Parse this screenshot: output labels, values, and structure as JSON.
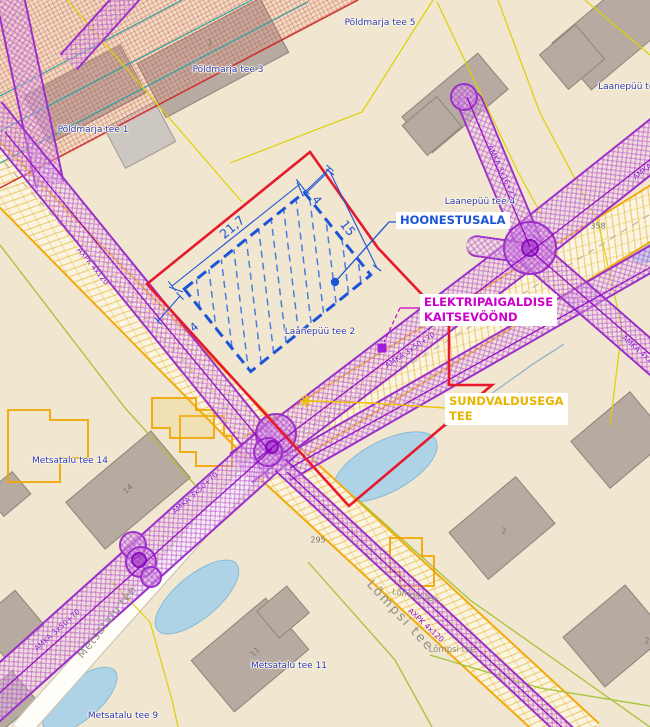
{
  "map": {
    "street_labels": [
      {
        "text": "Põldmarja tee 5",
        "x": 380,
        "y": 23
      },
      {
        "text": "Põldmarja tee 3",
        "x": 228,
        "y": 70
      },
      {
        "text": "Põldmarja tee 1",
        "x": 93,
        "y": 130
      },
      {
        "text": "Laanepüü tee",
        "x": 629,
        "y": 87
      },
      {
        "text": "Laanepüü tee 4",
        "x": 480,
        "y": 202
      },
      {
        "text": "Laanepüü tee 2",
        "x": 320,
        "y": 332
      },
      {
        "text": "Metsatalu tee 14",
        "x": 70,
        "y": 461
      },
      {
        "text": "Metsatalu tee 11",
        "x": 289,
        "y": 666
      },
      {
        "text": "Metsatalu tee 9",
        "x": 123,
        "y": 716
      }
    ],
    "parcel_labels": [
      {
        "text": "358",
        "x": 598,
        "y": 226,
        "rot": 0
      },
      {
        "text": "295",
        "x": 318,
        "y": 540,
        "rot": 0
      },
      {
        "text": "1",
        "x": 210,
        "y": 43,
        "rot": 0
      },
      {
        "text": "14",
        "x": 128,
        "y": 489,
        "rot": -45
      },
      {
        "text": "11",
        "x": 255,
        "y": 652,
        "rot": -45
      },
      {
        "text": "2",
        "x": 504,
        "y": 531,
        "rot": 0
      },
      {
        "text": "2",
        "x": 647,
        "y": 641,
        "rot": 0
      }
    ],
    "road_labels": [
      {
        "text": "Lõmpsi tee",
        "x": 400,
        "y": 616,
        "rot": 47,
        "size": 13
      },
      {
        "text": "Lõmpsi tee",
        "x": 415,
        "y": 596,
        "rot": 10,
        "size": 8.5
      },
      {
        "text": "Lõmpsi tee",
        "x": 452,
        "y": 650,
        "rot": 0,
        "size": 8.5
      },
      {
        "text": "Metsatalu tee",
        "x": 107,
        "y": 622,
        "rot": -52,
        "size": 11
      }
    ],
    "cable_labels": [
      {
        "text": "AMKA 3x16+25",
        "x": 502,
        "y": 172,
        "rot": 65
      },
      {
        "text": "AMKA 3x50+70",
        "x": 410,
        "y": 350,
        "rot": -34
      },
      {
        "text": "AXPK 4x120",
        "x": 93,
        "y": 266,
        "rot": 51
      },
      {
        "text": "AMKA 3x50+70",
        "x": 195,
        "y": 493,
        "rot": -42
      },
      {
        "text": "AMKA 3x50+70",
        "x": 57,
        "y": 630,
        "rot": -42
      },
      {
        "text": "AXPK 4x120",
        "x": 426,
        "y": 625,
        "rot": 43
      },
      {
        "text": "AMKA 4x120",
        "x": 641,
        "y": 352,
        "rot": 41
      },
      {
        "text": "AMKA 3x50+70",
        "x": 657,
        "y": 160,
        "rot": -38
      }
    ],
    "annotations": {
      "hoonestusala": "HOONESTUSALA",
      "kaitsevoond_1": "ELEKTRIPAIGALDISE",
      "kaitsevoond_2": "KAITSEVÖÖND",
      "sundvaldus_1": "SUNDVALDUSEGA",
      "sundvaldus_2": "TEE"
    },
    "dimensions": {
      "long": "21,7",
      "short": "15",
      "offset_top": "4",
      "offset_left": "4"
    },
    "colors": {
      "hoonestusala": "#1c54d8",
      "kaitsevoond": "#cc00cc",
      "sundvaldus": "#e8b400",
      "protection_zone": "#9b2fc8",
      "plan_boundary": "#e8192c",
      "road_edge": "#f2a90a"
    }
  }
}
